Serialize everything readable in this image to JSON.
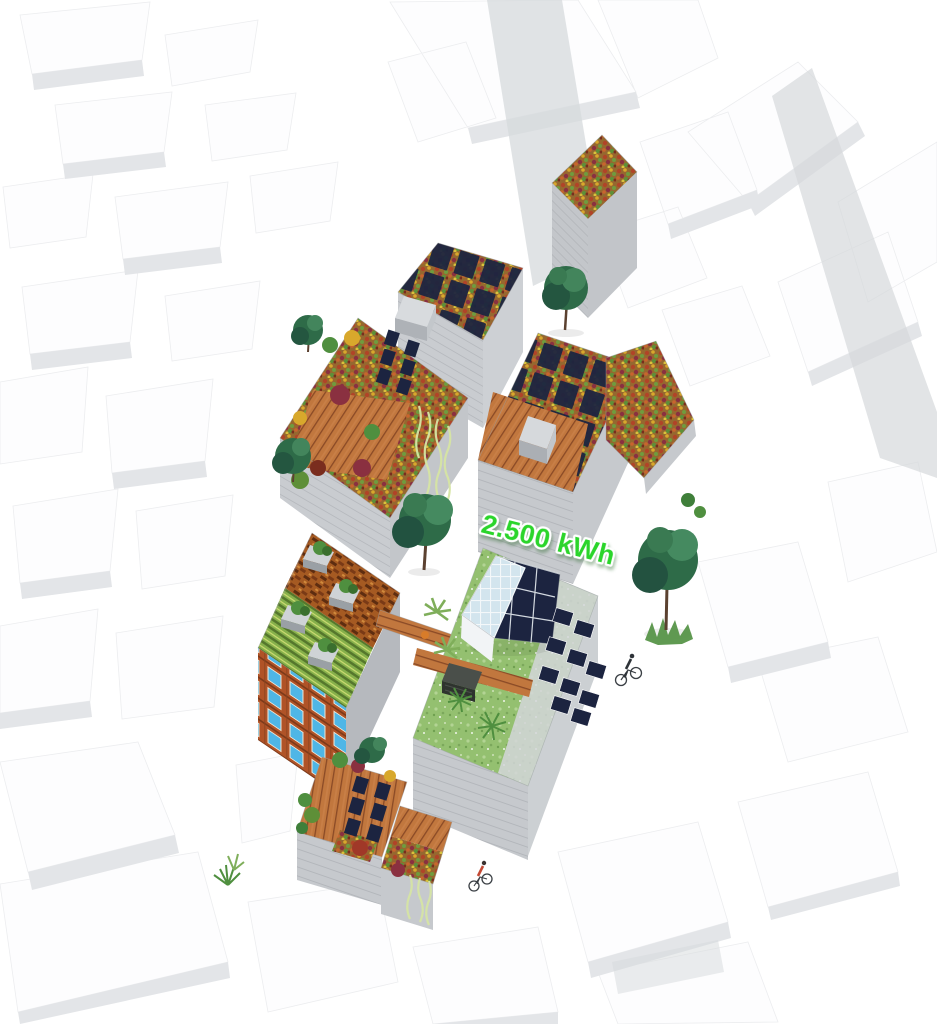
{
  "annotation": {
    "energy_label": "2.500 kWh"
  },
  "colors": {
    "label_green": "#2bd52b",
    "solar_panel": "#1c2440",
    "deck_wood": "#c1773e",
    "brick_facade": "#b05327",
    "window_glass": "#4fb6e6",
    "lawn_green": "#94c070",
    "sedum_base": "#96682f",
    "tree_foliage": "#2e6b48",
    "facade_gray": "#c6c9cd",
    "context_white": "#fdfdfe",
    "context_shade": "#e3e5e8",
    "vine_green": "#d6e5a4",
    "glass_pane": "#d3e5ee",
    "cyclist_shirt_red": "#c44a35"
  }
}
